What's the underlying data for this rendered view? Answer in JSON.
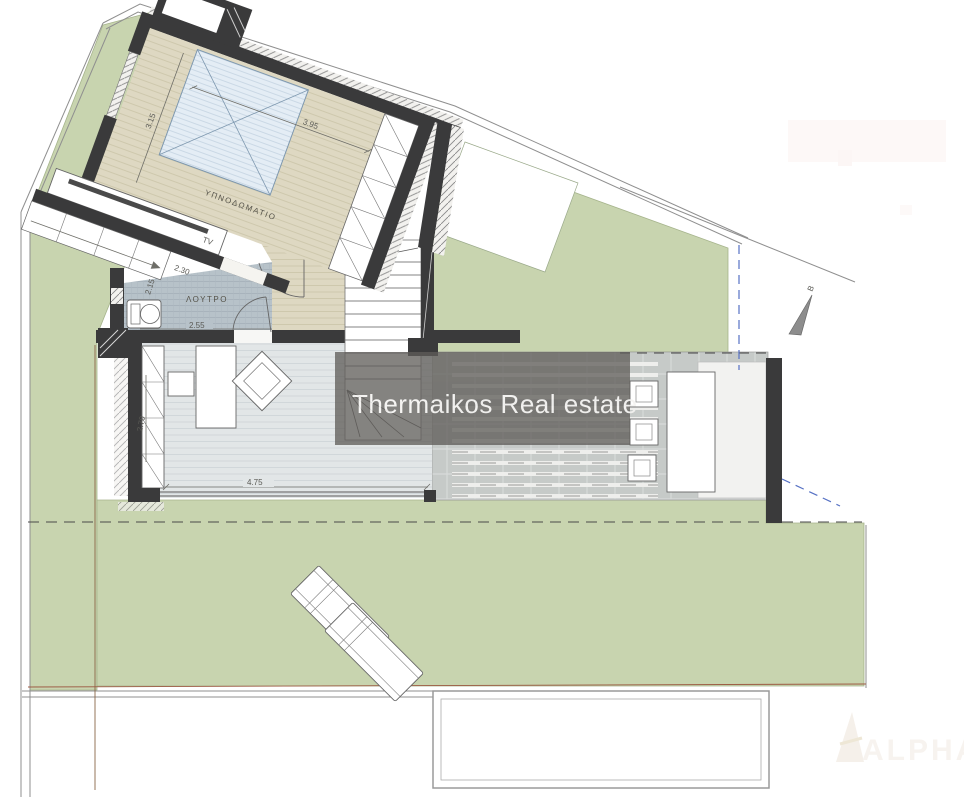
{
  "colors": {
    "garden": "#c8d4af",
    "garden_edge": "#a6b48c",
    "wall": "#3a3a3b",
    "bedroom_floor": "#ded8c2",
    "bath_floor": "#b7c2c9",
    "living_floor": "#e2e6e7",
    "tile": "#c6cac8",
    "bed_fill": "#e4edf5",
    "banner": "rgba(95,93,89,0.85)",
    "banner_text": "#f4f3f1",
    "blue_dash": "#5671c4",
    "boundary": "#8f8f8f",
    "brown_line": "#96613f",
    "dim_text": "#5a5a55"
  },
  "labels": {
    "bedroom": "ΥΠΝΟΔΩΜΑΤΙΟ",
    "bathroom": "ΛΟΥΤΡΟ",
    "tv": "TV",
    "section_marker": "B"
  },
  "dimensions": {
    "bedroom_width": "3.95",
    "bedroom_depth": "3.15",
    "wardrobe_width": "2.30",
    "bathroom_depth": "2.15",
    "bathroom_width": "2.55",
    "living_depth": "2.70",
    "living_width": "4.75"
  },
  "watermarks": {
    "banner": "Thermaikos Real estate",
    "corner_logo": "ALPHA"
  }
}
